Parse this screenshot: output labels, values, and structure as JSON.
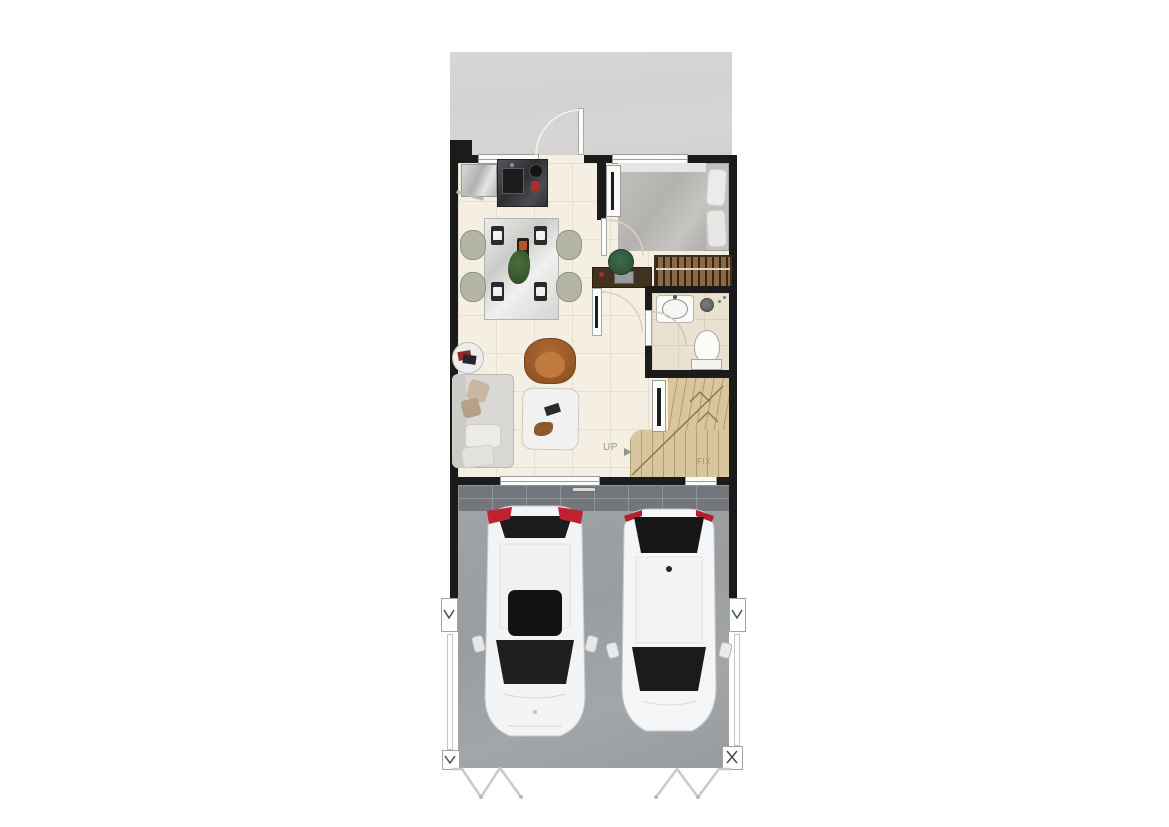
{
  "labels": {
    "up": "UP",
    "fix": "FIX"
  },
  "colors": {
    "wall": "#1b1b1b",
    "patio": "#d5d4d2",
    "floor": "#f4efe2",
    "floorLine": "#e7e0cf",
    "bath": "#eae2d0",
    "bathLine": "#dbd2bd",
    "wood": "#d9c59e",
    "woodLine": "#b29d72",
    "paver": "#73777b",
    "paverLine": "#90949a",
    "garage": "#9da0a3",
    "carBody": "#f4f5f6",
    "carGlass": "#17181a",
    "tailRed": "#c02330",
    "sofa": "#d9d8d4",
    "chairOlive": "#b5b5a4",
    "armchair": "#a9622d",
    "deskWood": "#41311f",
    "chairGreen": "#33593f",
    "wardrobe": "#8a6844",
    "labelGray": "#96948e",
    "labelTan": "#a79766",
    "doorFrame": "#a8a8a6"
  },
  "plan": {
    "floors_shown": 1,
    "areas": [
      "entry patio",
      "kitchen",
      "dining area",
      "living area",
      "bedroom",
      "wardrobe closet",
      "bathroom",
      "staircase up",
      "two-car carport"
    ],
    "furniture": [
      "refrigerator",
      "kitchen counter with sink and cooktop",
      "dining table with four chairs",
      "round side table",
      "sofa",
      "armchair",
      "coffee table",
      "double bed",
      "desk with chair",
      "open wardrobe",
      "washbasin",
      "shower",
      "toilet"
    ],
    "vehicles": [
      "white suv rear-in",
      "white hatchback rear-in"
    ],
    "stair_labels": [
      "UP",
      "FIX"
    ]
  }
}
